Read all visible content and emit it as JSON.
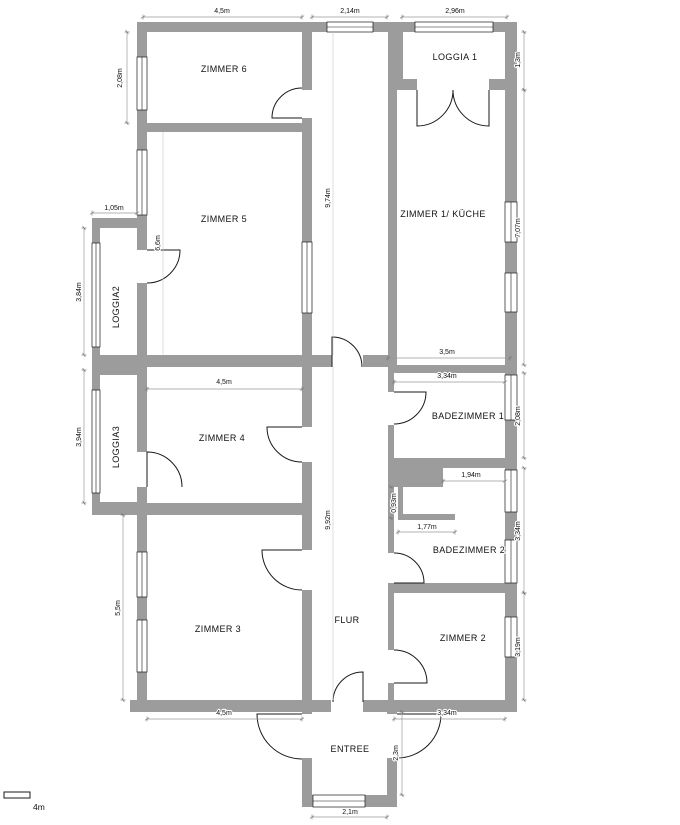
{
  "plan": {
    "rooms": {
      "zimmer6": "ZIMMER 6",
      "zimmer5": "ZIMMER 5",
      "loggia2": "LOGGIA2",
      "loggia3": "LOGGIA3",
      "zimmer4": "ZIMMER 4",
      "zimmer3": "ZIMMER 3",
      "flur": "FLUR",
      "entree": "ENTREE",
      "zimmer1": "ZIMMER 1/ KÜCHE",
      "loggia1": "LOGGIA 1",
      "badezimmer1": "BADEZIMMER 1",
      "badezimmer2": "BADEZIMMER 2",
      "zimmer2": "ZIMMER 2"
    },
    "dimensions": {
      "top_left": "4,5m",
      "top_middle": "2,14m",
      "top_right": "2,96m",
      "zimmer6_left": "2,08m",
      "loggia1_right": "1,3m",
      "zimmer1_right": "7,07m",
      "flur_upper": "9,74m",
      "zimmer5_interior": "6,6m",
      "loggia2_top": "1,05m",
      "loggia2_left": "3,84m",
      "loggia3_left": "3,94m",
      "zimmer4_top": "4,5m",
      "zimmer1_bottom": "3,5m",
      "badezimmer1_top": "3,34m",
      "badezimmer1_right": "2,08m",
      "badezimmer2_top": "1,94m",
      "badezimmer2_niche_height": "0,93m",
      "badezimmer2_niche_width": "1,77m",
      "badezimmer2_right": "3,34m",
      "flur_lower": "9,92m",
      "zimmer3_left": "5,5m",
      "zimmer2_right": "3,19m",
      "zimmer3_bottom": "4,5m",
      "zimmer2_bottom": "3,34m",
      "entree_right": "2,3m",
      "entree_bottom": "2,1m"
    },
    "scale_bar": "4m",
    "colors": {
      "wall": "#9c9c9c",
      "background": "#ffffff",
      "dimension": "#9a9a9a",
      "line": "#111111"
    }
  }
}
